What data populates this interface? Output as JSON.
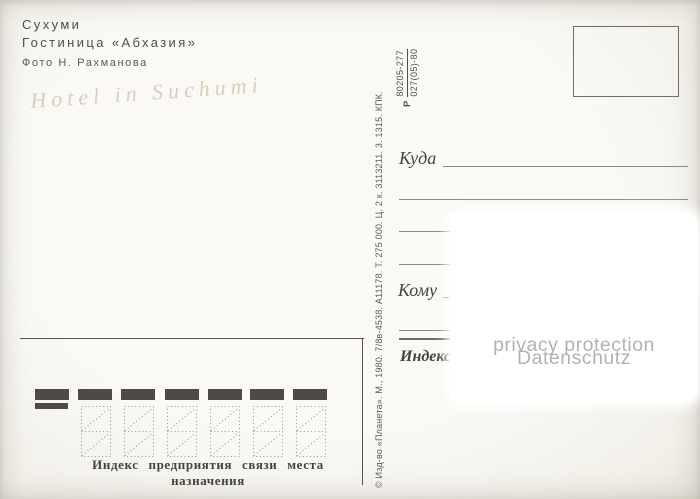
{
  "postcard": {
    "title_block": {
      "city": "Сухуми",
      "subject": "Гостиница «Абхазия»",
      "photo_credit": "Фото Н. Рахманова"
    },
    "handwriting": "Hotel in Suchumi",
    "catalog": {
      "prefix": "Р",
      "numerator": "80205-277",
      "denominator": "027(05)-80"
    },
    "imprint": "© Изд-во «Планета». М., 1980. 7/8в-4538. А11178. Т. 275 000. Ц. 2 к. 3113211. 3. 1315. КПК.",
    "address": {
      "to_label": "Куда",
      "recipient_label": "Кому",
      "index_label": "Индекс"
    },
    "index_zone": {
      "caption": "Индекс предприятия связи места назначения"
    },
    "privacy_overlay": {
      "line1": "privacy protection",
      "line2": "Datenschutz"
    },
    "colors": {
      "ink": "#4e4c45",
      "mark_box": "#4d4b43",
      "watermark_text": "#b4b2ae"
    }
  }
}
